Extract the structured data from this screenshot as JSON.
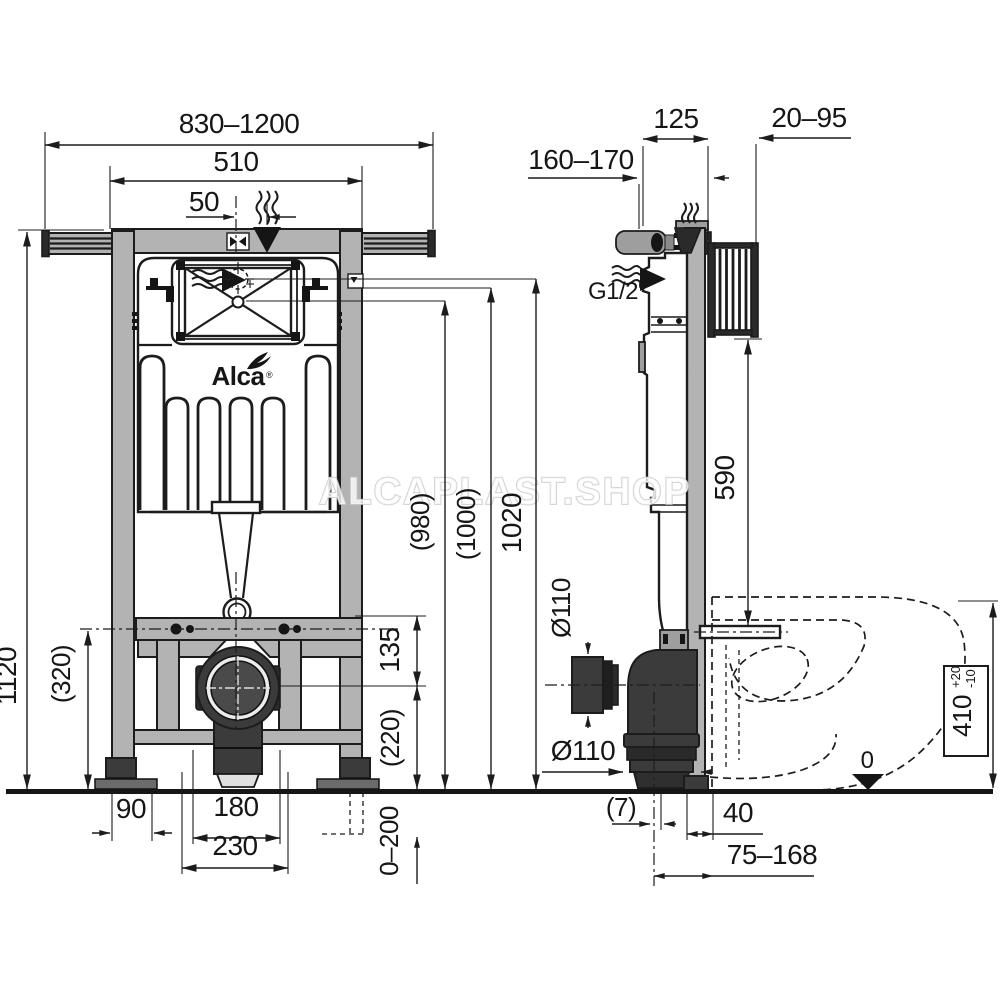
{
  "watermark": "ALCAPLAST.SHOP",
  "logo": {
    "name": "Alca",
    "registered": "®"
  },
  "front_view": {
    "overall_width": "830–1200",
    "frame_width": "510",
    "flush_offset": "50",
    "frame_height": "1120",
    "lower_rail_height": "(320)",
    "height_980": "(980)",
    "height_1000": "(1000)",
    "height_1020": "1020",
    "drain_to_rail": "135",
    "drain_height": "(220)",
    "leg_extension": "0–200",
    "foot_width": "90",
    "drain_span_180": "180",
    "drain_span_230": "230"
  },
  "side_view": {
    "wall_distance": "160–170",
    "frame_depth": "125",
    "bracket_range": "20–95",
    "water_inlet": "G1/2\"",
    "flush_pipe_height": "590",
    "sleeve_diameter": "Ø110",
    "outlet_diameter": "Ø110",
    "offset_7": "(7)",
    "outlet_distance_40": "40",
    "outlet_range": "75–168",
    "bowl_height": {
      "value": "410",
      "tol_plus": "+20",
      "tol_minus": "-10"
    },
    "datum_zero": "0"
  }
}
